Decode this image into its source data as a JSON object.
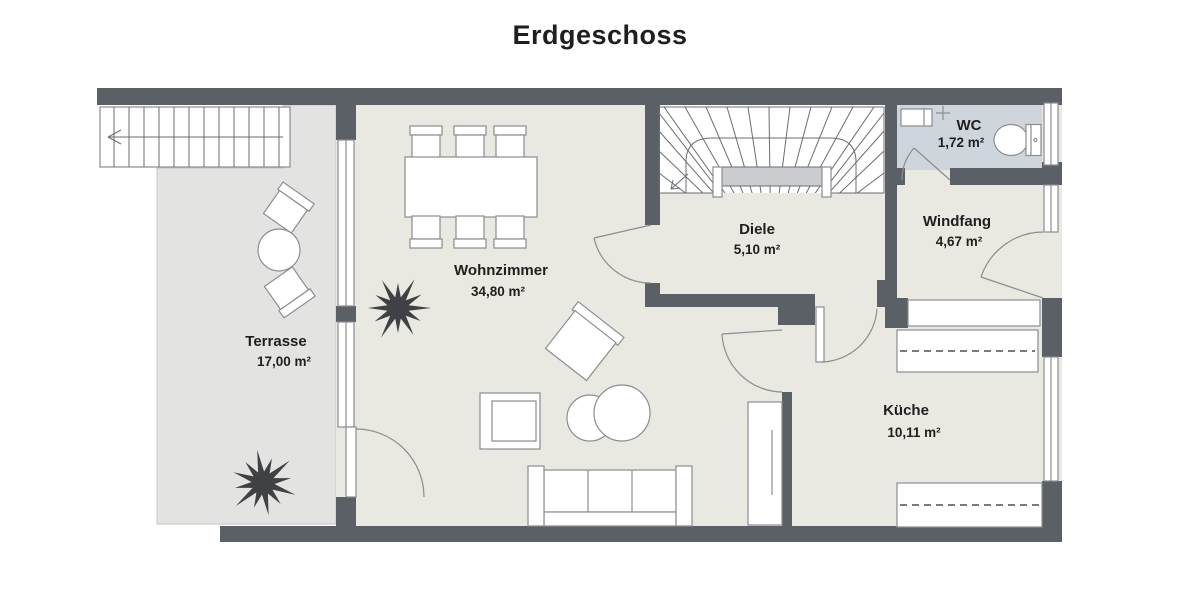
{
  "title": "Erdgeschoss",
  "floor_plan": {
    "rooms": {
      "wohnzimmer": {
        "name": "Wohnzimmer",
        "area": "34,80 m²"
      },
      "terrasse": {
        "name": "Terrasse",
        "area": "17,00 m²"
      },
      "diele": {
        "name": "Diele",
        "area": "5,10 m²"
      },
      "wc": {
        "name": "WC",
        "area": "1,72 m²"
      },
      "windfang": {
        "name": "Windfang",
        "area": "4,67 m²"
      },
      "kueche": {
        "name": "Küche",
        "area": "10,11 m²"
      }
    },
    "colors": {
      "wall": "#5b6067",
      "floor": "#e9e8e1",
      "terrace": "#e3e3e2",
      "wc-floor": "#ced5dd",
      "line": "#8b8d90",
      "stair-line": "#6a6d72",
      "landing": "#caccd0",
      "plant": "#3f4144",
      "text": "#1f1f1f"
    }
  }
}
